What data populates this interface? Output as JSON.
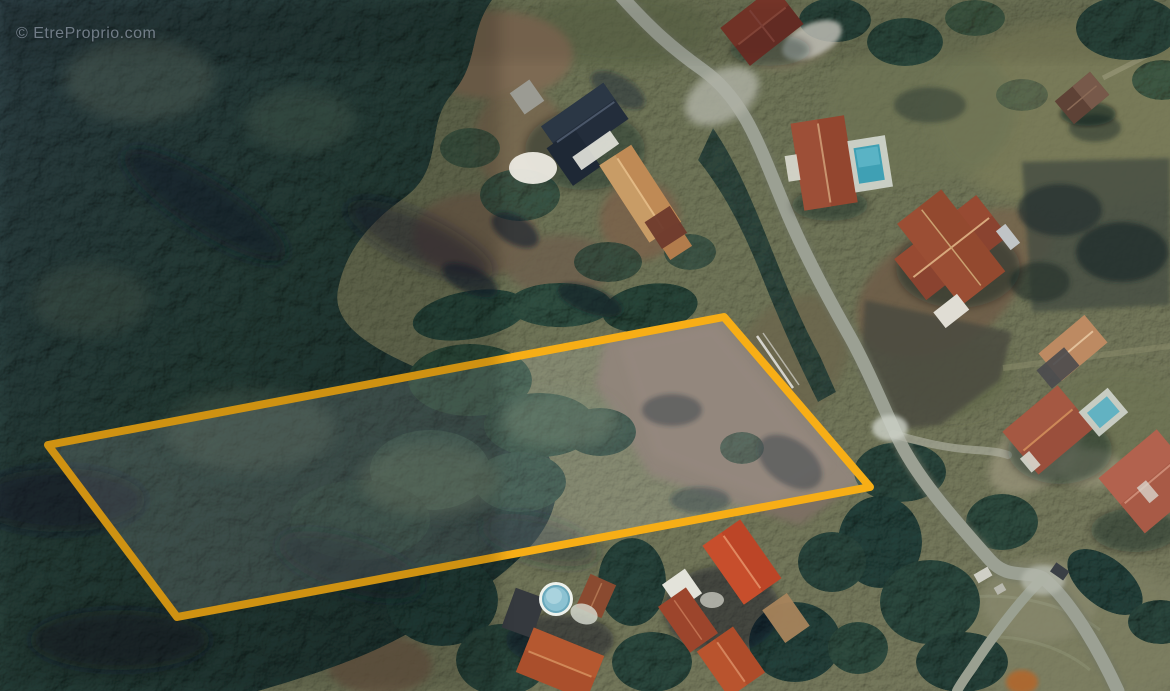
{
  "page": {
    "width_px": 1170,
    "height_px": 691,
    "description": "Aerial satellite photograph of a wooded building plot for sale, outlined in orange, bordered by forest to the west and houses with red tile roofs along a country road to the east"
  },
  "watermark": {
    "text": "© EtreProprio.com"
  },
  "parcel": {
    "points": "48,445 724,317 870,487 177,617",
    "outline_color": "#F7AE16",
    "fill_color": "rgba(255,255,255,0.15)",
    "stroke_width": 8
  },
  "scene": {
    "palette": {
      "forest": "#2b4540",
      "forest_shadow": "#101a2e",
      "field": "#6f7656",
      "dirt": "#7b6a58",
      "parcel_dirt": "#7d6f63",
      "road": "#9ba093",
      "roof_red": "#a84c30",
      "roof_bright_red": "#bc4527",
      "roof_dark_navy": "#232d3b",
      "roof_tan": "#bf8a55",
      "pool_water": "#4fa8bc",
      "white_patio": "#d8dcd2"
    }
  }
}
